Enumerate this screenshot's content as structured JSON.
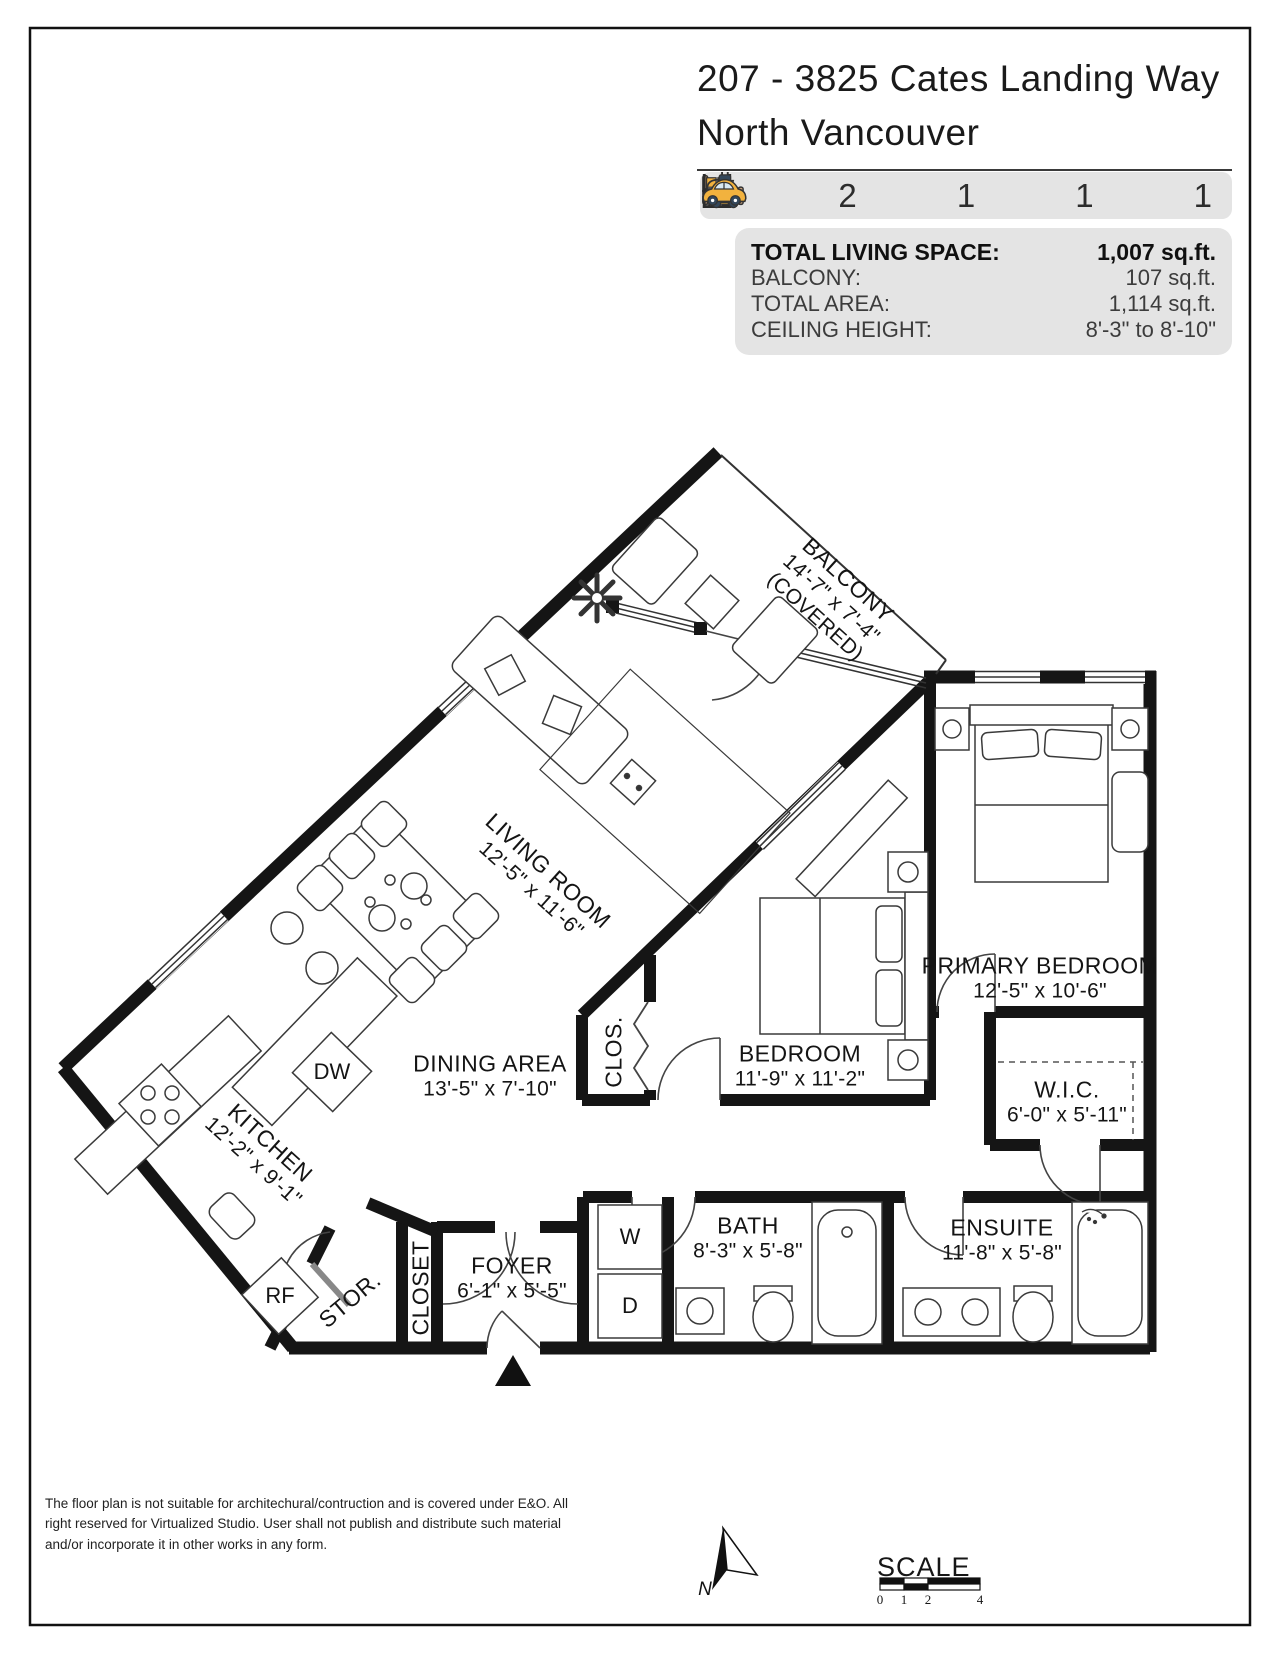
{
  "page": {
    "title_line1": "207 - 3825 Cates Landing Way",
    "title_line2": "North Vancouver"
  },
  "features": [
    {
      "id": "bedrooms",
      "icon": "bed-icon",
      "count": "2"
    },
    {
      "id": "bathrooms",
      "icon": "bath-icon",
      "count": "2"
    },
    {
      "id": "storage",
      "icon": "storage-icon",
      "count": "1"
    },
    {
      "id": "ev-parking",
      "icon": "ev-charger-icon",
      "count": "1"
    },
    {
      "id": "parking",
      "icon": "car-icon",
      "count": "1"
    }
  ],
  "stats": {
    "rows": [
      {
        "label": "TOTAL LIVING SPACE:",
        "value": "1,007 sq.ft."
      },
      {
        "label": "BALCONY:",
        "value": "107 sq.ft."
      },
      {
        "label": "TOTAL AREA:",
        "value": "1,114 sq.ft."
      },
      {
        "label": "CEILING HEIGHT:",
        "value": "8'-3\" to 8'-10\""
      }
    ]
  },
  "rooms": [
    {
      "id": "balcony",
      "name": "BALCONY",
      "dims": "14'-7\" x 7'-4\"",
      "note": "(COVERED)"
    },
    {
      "id": "living-room",
      "name": "LIVING ROOM",
      "dims": "12'-5\" x 11'-6\""
    },
    {
      "id": "dining-area",
      "name": "DINING AREA",
      "dims": "13'-5\" x 7'-10\""
    },
    {
      "id": "kitchen",
      "name": "KITCHEN",
      "dims": "12'-2\" x 9'-1\""
    },
    {
      "id": "primary-bedroom",
      "name": "PRIMARY BEDROOM",
      "dims": "12'-5\" x 10'-6\""
    },
    {
      "id": "bedroom",
      "name": "BEDROOM",
      "dims": "11'-9\" x 11'-2\""
    },
    {
      "id": "wic",
      "name": "W.I.C.",
      "dims": "6'-0\" x 5'-11\""
    },
    {
      "id": "bath",
      "name": "BATH",
      "dims": "8'-3\" x 5'-8\""
    },
    {
      "id": "ensuite",
      "name": "ENSUITE",
      "dims": "11'-8\" x 5'-8\""
    },
    {
      "id": "foyer",
      "name": "FOYER",
      "dims": "6'-1\" x 5'-5\""
    },
    {
      "id": "closet",
      "name": "CLOSET"
    },
    {
      "id": "clos",
      "name": "CLOS."
    },
    {
      "id": "stor",
      "name": "STOR."
    }
  ],
  "appliances": {
    "dishwasher": "DW",
    "fridge": "RF",
    "washer": "W",
    "dryer": "D"
  },
  "footer": {
    "disclaimer": "The floor plan is not suitable for architechural/contruction and is covered under E&O. All right reserved for Virtualized Studio. User shall not publish and distribute such material and/or incorporate it in other works in any form.",
    "north_label": "N",
    "scale": {
      "title": "SCALE",
      "ticks": [
        "0",
        "1",
        "2",
        "4"
      ]
    }
  },
  "colors": {
    "wall": "#151515",
    "panel_gray": "#e4e4e4",
    "icon_yellow": "#f2b23e",
    "icon_orange": "#f5a04a",
    "icon_blue": "#d7e8f2",
    "icon_navy": "#33475b",
    "icon_tan": "#c9a27e"
  }
}
